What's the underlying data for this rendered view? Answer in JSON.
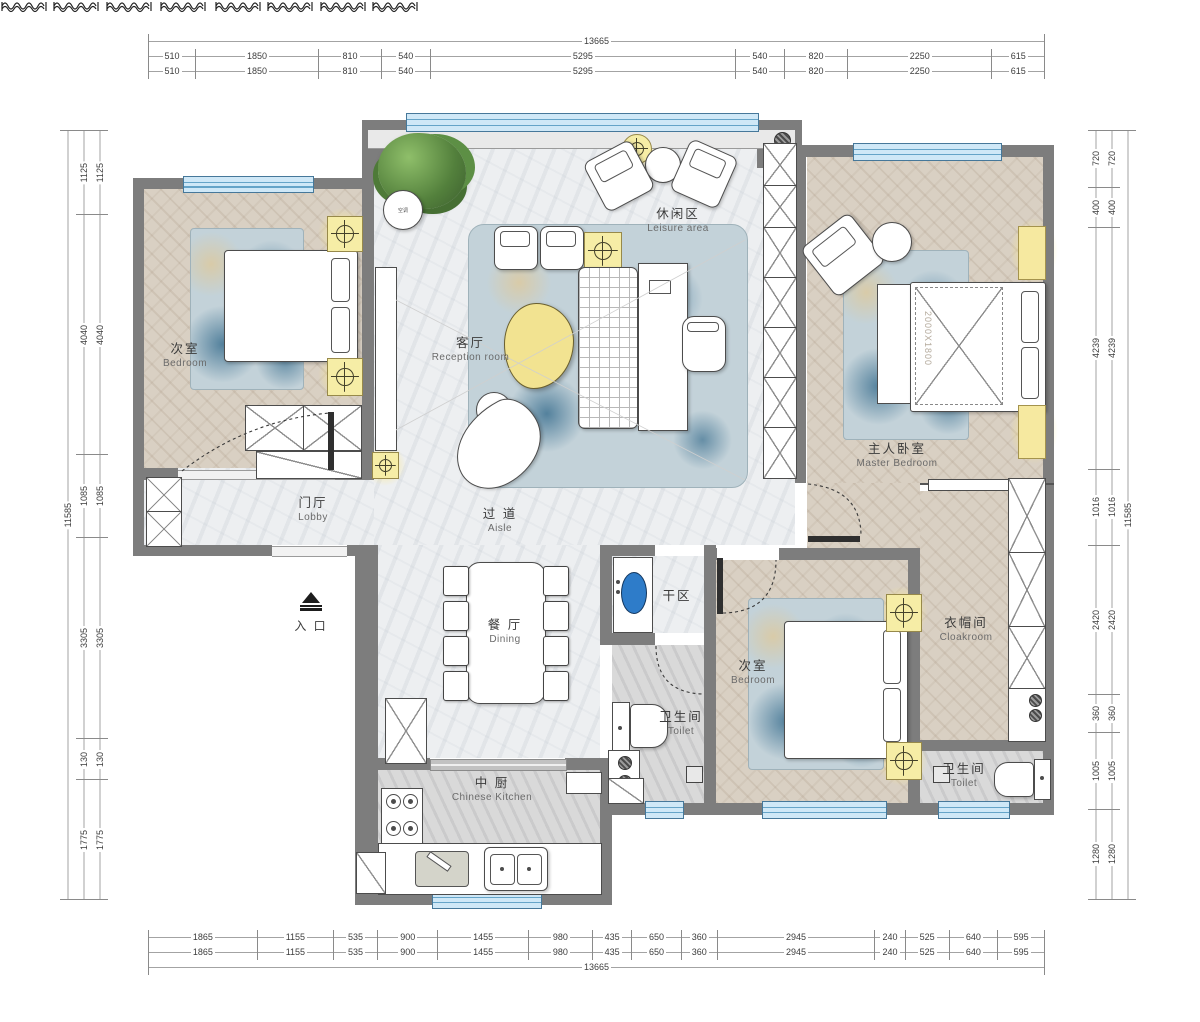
{
  "dimensions": {
    "top": {
      "total": "13665",
      "row": [
        "510",
        "1850",
        "810",
        "540",
        "5295",
        "540",
        "820",
        "2250",
        "615"
      ]
    },
    "bottom": {
      "total": "13665",
      "row": [
        "1865",
        "1155",
        "535",
        "900",
        "1455",
        "980",
        "435",
        "650",
        "360",
        "2945",
        "240",
        "525",
        "640",
        "595"
      ]
    },
    "left": {
      "total": "11585",
      "row": [
        "1125",
        "4040",
        "1085",
        "3305",
        "130",
        "1775"
      ]
    },
    "right": {
      "total": "11585",
      "row": [
        "720",
        "400",
        "4239",
        "1016",
        "2420",
        "360",
        "1005",
        "1280"
      ]
    }
  },
  "rooms": {
    "bedroom1": {
      "zh": "次室",
      "en": "Bedroom"
    },
    "lobby": {
      "zh": "门厅",
      "en": "Lobby"
    },
    "reception": {
      "zh": "客厅",
      "en": "Reception  room"
    },
    "leisure": {
      "zh": "休闲区",
      "en": "Leisure area"
    },
    "aisle": {
      "zh": "过 道",
      "en": "Aisle"
    },
    "master": {
      "zh": "主人卧室",
      "en": "Master Bedroom"
    },
    "dining": {
      "zh": "餐 厅",
      "en": "Dining"
    },
    "dry": {
      "zh": "干区",
      "en": ""
    },
    "toilet_mid": {
      "zh": "卫生间",
      "en": "Toilet"
    },
    "bedroom2": {
      "zh": "次室",
      "en": "Bedroom"
    },
    "cloakroom": {
      "zh": "衣帽间",
      "en": "Cloakroom"
    },
    "toilet_br": {
      "zh": "卫生间",
      "en": "Toilet"
    },
    "kitchen": {
      "zh": "中 厨",
      "en": "Chinese Kitchen"
    },
    "entrance": {
      "zh": "入 口",
      "en": ""
    }
  },
  "furniture": {
    "master_bed_size": "2000X1800",
    "side_table_label": "空调"
  },
  "colors": {
    "wall": "#7d7d7d",
    "window": "#cfe8f7",
    "accent_yellow": "#f6eda6",
    "rug_blue": "#7ba6bc",
    "wood": "#d9d0c3"
  }
}
